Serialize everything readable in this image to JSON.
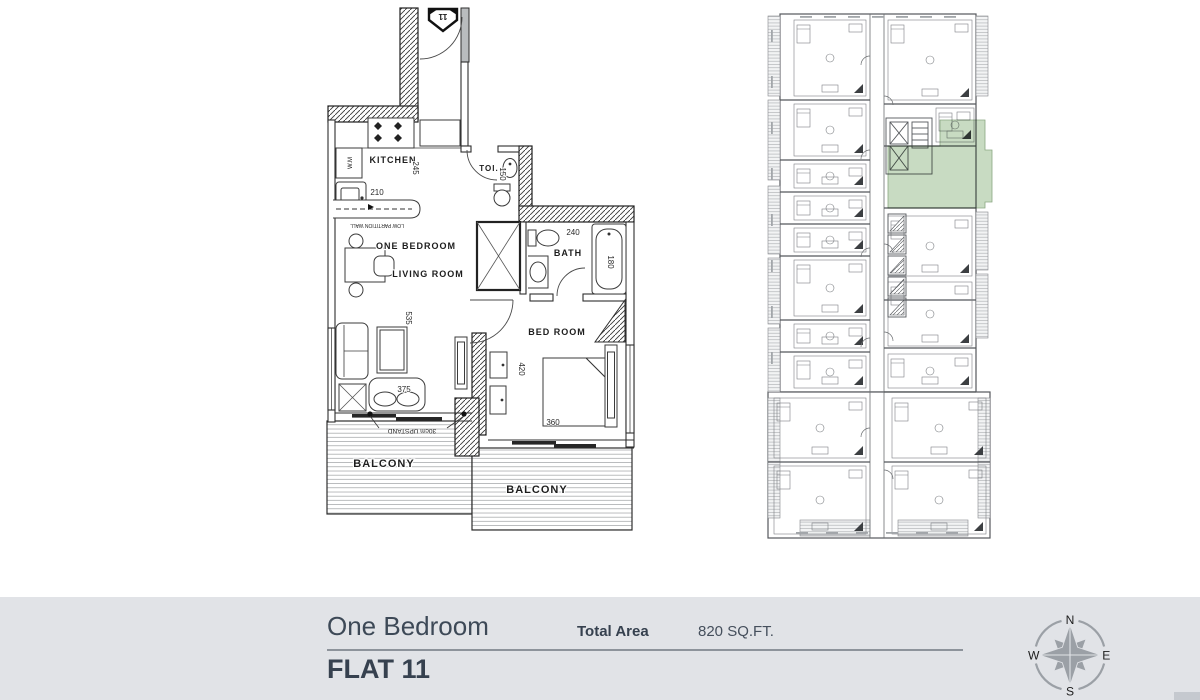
{
  "unit_plan": {
    "entry_marker": "11",
    "labels": {
      "kitchen": "KITCHEN",
      "toilet": "TOI.",
      "bath": "BATH",
      "one_bedroom": "ONE BEDROOM",
      "living_room": "LIVING ROOM",
      "bed_room": "BED ROOM",
      "balcony_left": "BALCONY",
      "balcony_right": "BALCONY",
      "upstand": "30cm UPSTAND",
      "low_partition": "LOW PARTITION WALL",
      "washing_machine": "W.M"
    },
    "dimensions": {
      "kitchen_width": "210",
      "kitchen_depth": "245",
      "toilet_depth": "150",
      "bath_width": "240",
      "bathtub_length": "180",
      "living_depth": "535",
      "sofa_width": "375",
      "bedroom_depth": "420",
      "bed_width": "360"
    }
  },
  "key_plan": {
    "highlight_color": "#b6cfad"
  },
  "footer": {
    "type_label": "One Bedroom",
    "flat_label": "FLAT 11",
    "total_area_label": "Total Area",
    "total_area_value": "820 SQ.FT.",
    "background": "#e1e3e7",
    "text_color": "#3d4957"
  },
  "compass": {
    "north": "N",
    "east": "E",
    "south": "S",
    "west": "W"
  }
}
